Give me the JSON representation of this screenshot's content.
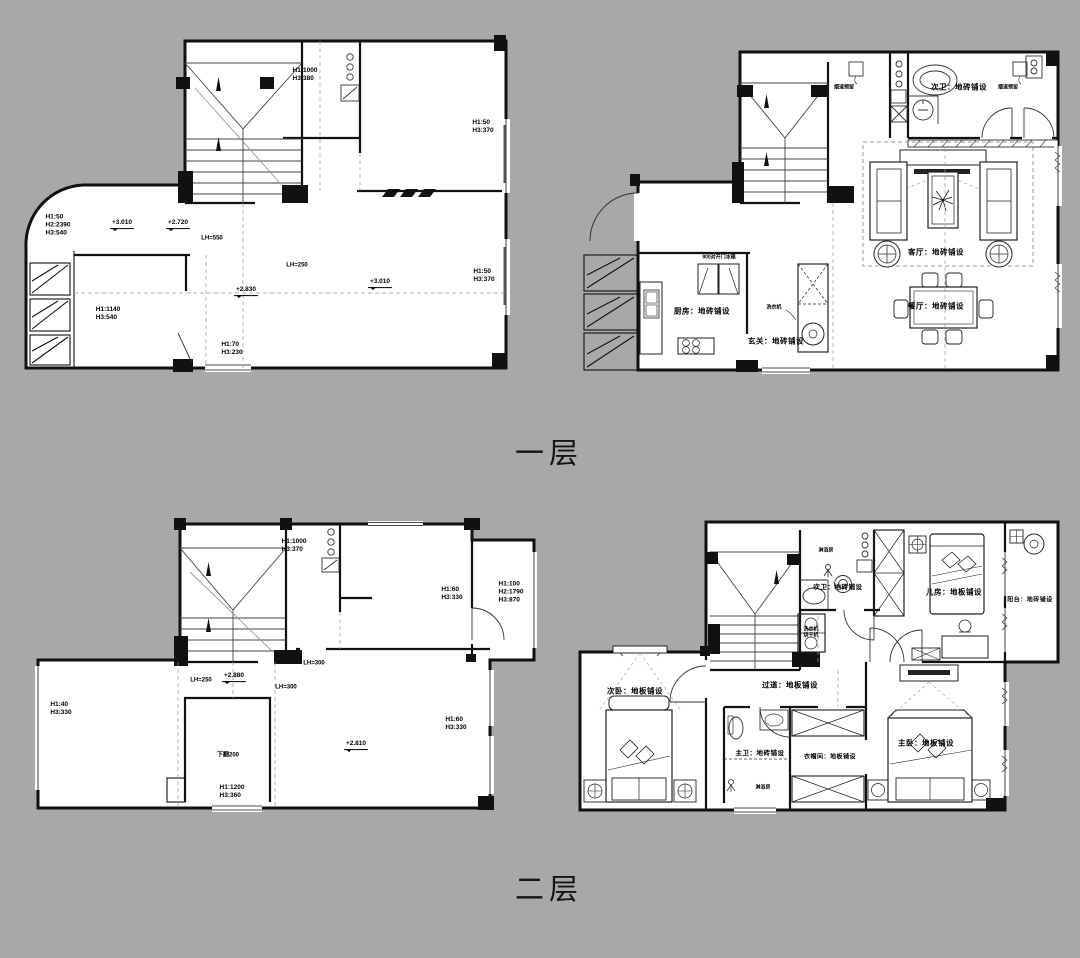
{
  "page": {
    "floor1_title": "一层",
    "floor2_title": "二层"
  },
  "plan1": {
    "labels": {
      "win_top": "H1:1000\nH3:380",
      "win_right_top": "H1:50\nH3:370",
      "door_left": "H1:50\nH2:2390\nH3:540",
      "lvl_a": "+3.010",
      "lvl_b": "+2.720",
      "lh_a": "LH=550",
      "lh_b": "LH=250",
      "lvl_c": "+2.830",
      "win_left": "H1:1140\nH3:540",
      "win_bottom": "H1:70\nH3:230",
      "lvl_d": "+3.010",
      "win_right_bottom": "H1:50\nH3:370"
    }
  },
  "plan2": {
    "labels": {
      "flue_left": "烟道预留",
      "flue_right": "烟道预留",
      "bath": "次卫：地砖铺设",
      "living": "客厅：地砖铺设",
      "dining": "餐厅：地砖铺设",
      "fridge": "900对开门冰箱",
      "kitchen": "厨房：地砖铺设",
      "washer": "洗衣机",
      "hall": "玄关：地砖铺设"
    }
  },
  "plan3": {
    "labels": {
      "win_top": "H1:1000\nH3:370",
      "win_mid": "H1:60\nH3:330",
      "win_right": "H1:100\nH2:1790\nH3:870",
      "lh_a": "LH=300",
      "lh_b": "LH=250",
      "lvl_a": "+2.880",
      "lh_c": "LH=300",
      "shaft": "下翻200",
      "lvl_b": "+2.810",
      "win_bottom": "H1:1200\nH3:360",
      "win_left": "H1:40\nH3:330",
      "win_right2": "H1:60\nH3:330"
    }
  },
  "plan4": {
    "labels": {
      "shower_top": "淋浴房",
      "bath2": "次卫：地砖铺设",
      "kids": "儿房：地板铺设",
      "balcony": "阳台：地砖铺设",
      "washer": "洗衣机\n烘干机",
      "hall": "过道：地板铺设",
      "bed2": "次卧：地板铺设",
      "bath_master": "主卫：地砖铺设",
      "shower_bottom": "淋浴房",
      "closet": "衣帽间：地板铺设",
      "master": "主卧：地板铺设"
    }
  }
}
